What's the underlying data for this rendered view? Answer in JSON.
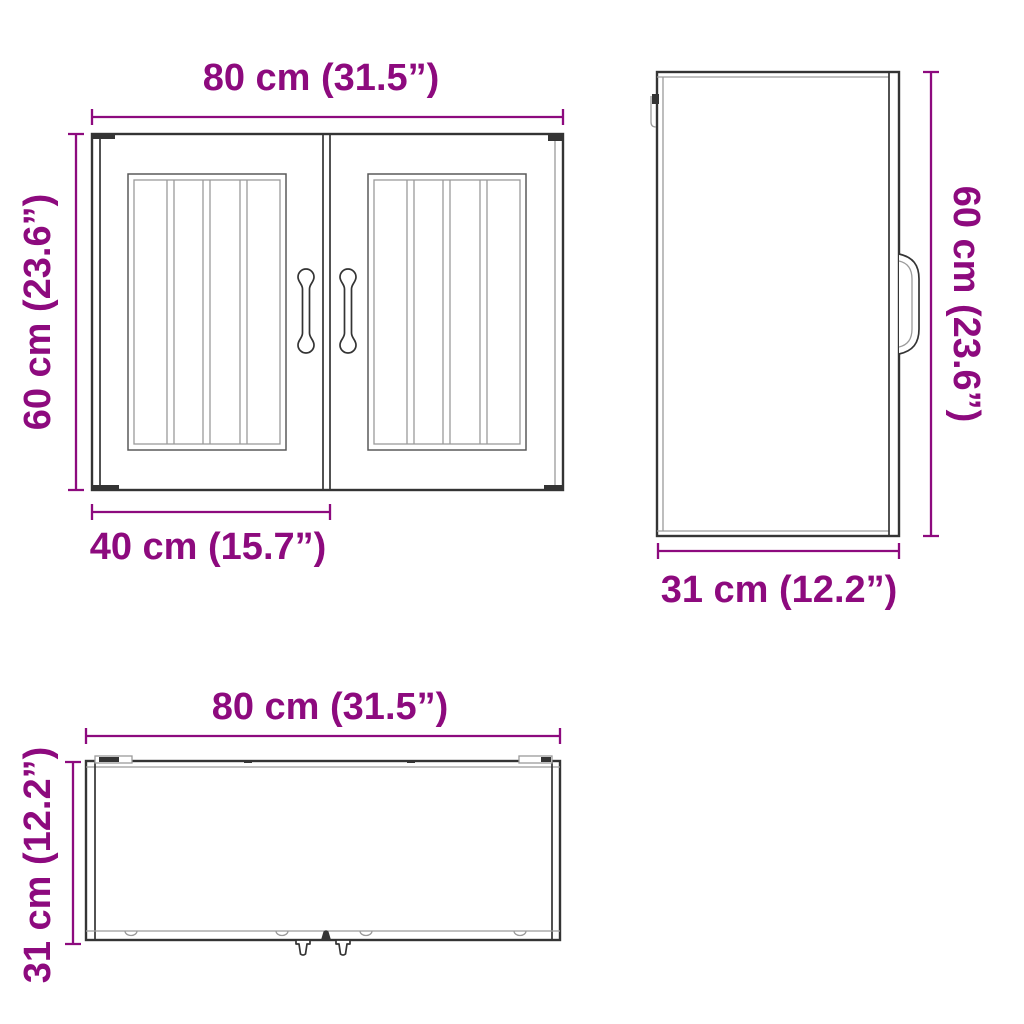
{
  "colors": {
    "dimension_text": "#8d0a7e",
    "outline_dark": "#343434",
    "outline_mid": "#5a5a5a",
    "outline_light": "#9a9a9a",
    "background": "#ffffff"
  },
  "views": {
    "front": {
      "width_label": "80 cm (31.5”)",
      "height_label": "60 cm (23.6”)",
      "door_width_label": "40 cm (15.7”)"
    },
    "side": {
      "height_label": "60 cm (23.6”)",
      "depth_label": "31 cm (12.2”)"
    },
    "top": {
      "width_label": "80 cm (31.5”)",
      "depth_label": "31 cm (12.2”)"
    }
  }
}
